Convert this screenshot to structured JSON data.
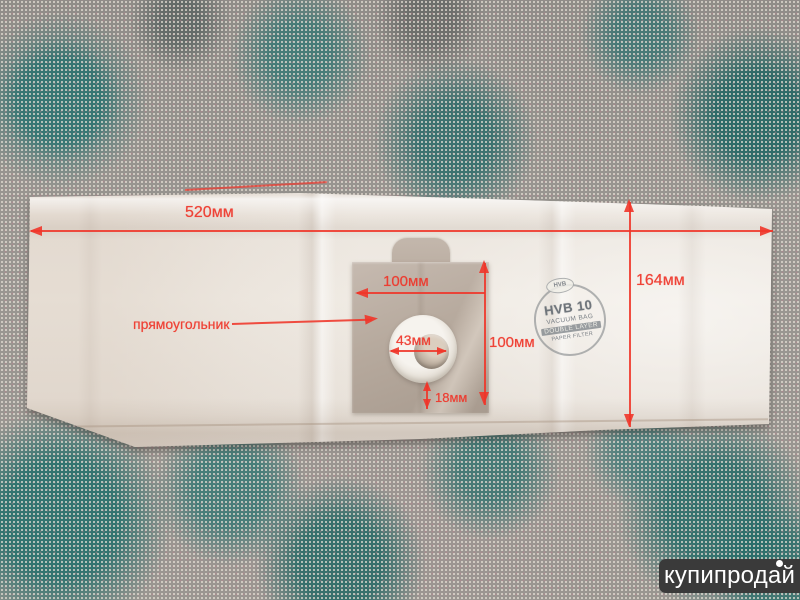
{
  "colors": {
    "annotation_red": "#ef3529",
    "bag_paper": "#ece6df",
    "plate_cardboard": "#b9ac9f",
    "fabric_teal": "#2e7c7a",
    "watermark_background": "#3a3a3a"
  },
  "annotations": {
    "bag_width_label": "520мм",
    "bag_height_label": "164мм",
    "plate_width_label": "100мм",
    "plate_height_label": "100мм",
    "hole_diameter_label": "43мм",
    "hole_bottom_offset_label": "18мм",
    "shape_label": "прямоугольник"
  },
  "stamp": {
    "badge": "HVB",
    "model": "HVB 10",
    "line1": "VACUUM BAG",
    "line2": "DOUBLE LAYER",
    "line3": "PAPER FILTER"
  },
  "watermark": {
    "text": "купипродай"
  }
}
